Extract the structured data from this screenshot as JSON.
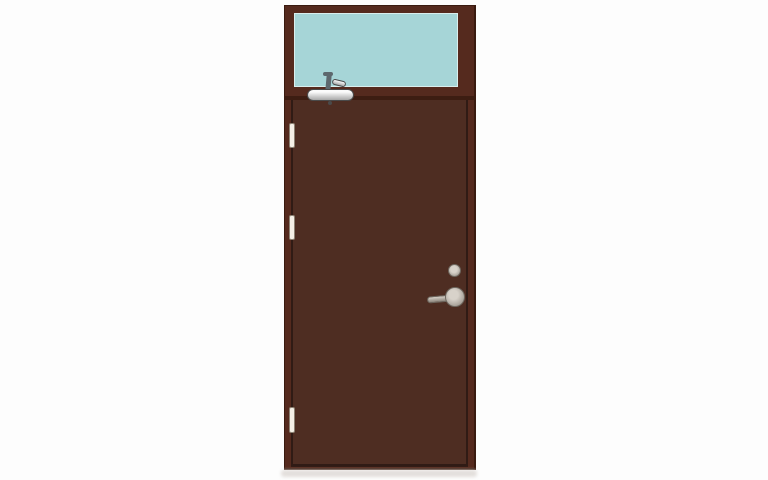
{
  "scene": {
    "description": "Product illustration of a dark brown steel fire door with a glazed transom window, overhead door closer, three hinges and a silver lever handle, on a plain white background with a soft floor shadow."
  },
  "door": {
    "hinge_count": 3,
    "parts": [
      "transom-window-glass",
      "door-closer",
      "hinge-top",
      "hinge-middle",
      "hinge-bottom",
      "lock-cylinder",
      "lever-handle",
      "floor-shadow"
    ]
  },
  "colors": {
    "background": "#fdfdfd",
    "frame_brown": "#552a1e",
    "leaf_brown": "#4e2d22",
    "edge_dark": "#3a1b10",
    "glass": "#a6d5d7",
    "glass_border": "#d9efee",
    "hinge": "#f4efe6",
    "hinge_border": "#8c8173",
    "closer_light": "#fbfbfb",
    "closer_dark": "#a8a8a8",
    "closer_outline": "#4a4a4a",
    "closer_arm": "#5d686e",
    "handle_light": "#d8d2ca",
    "handle_dark": "#8b847b",
    "handle_outline": "#6e675f",
    "shadow": "#e3dfdc"
  }
}
